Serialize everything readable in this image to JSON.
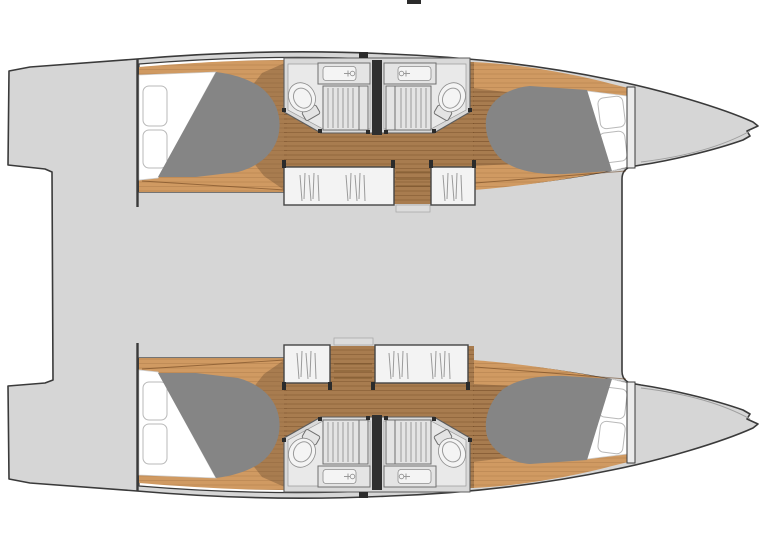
{
  "colors": {
    "background": "#ffffff",
    "deck": "#d6d6d6",
    "outline": "#3a3a3a",
    "interior": "#ffffff",
    "wood_light": "#d09a62",
    "wood_dark": "#a87c4f",
    "plank": "rgba(80,45,10,0.25)",
    "mattress": "#858585",
    "pillow_stroke": "#b9b9b9",
    "bath_base": "#d9d9d9",
    "bath_floor": "#e9e9e9",
    "fixture": "#e4e4e4",
    "fixture_stroke": "#6f6f6f",
    "divider": "#2f2f2f",
    "wardrobe": "#f3f3f3",
    "hanger": "#9a9a9a",
    "step": "#dcdcdc"
  },
  "plan": {
    "vessel_type": "catamaran",
    "view": "top-down layout plan",
    "orientation": "bows-right",
    "hulls": [
      {
        "position": "top",
        "rooms": [
          "aft-double-cabin",
          "head-aft",
          "head-forward",
          "wardrobes",
          "companionway-stairs",
          "forward-double-cabin"
        ]
      },
      {
        "position": "bottom",
        "rooms": [
          "aft-double-cabin",
          "head-aft",
          "head-forward",
          "wardrobes",
          "companionway-stairs",
          "forward-double-cabin"
        ]
      }
    ],
    "counts": {
      "double_berths": 4,
      "heads": 4,
      "toilets": 4,
      "sinks": 4,
      "showers": 4,
      "wardrobes": 4
    }
  }
}
